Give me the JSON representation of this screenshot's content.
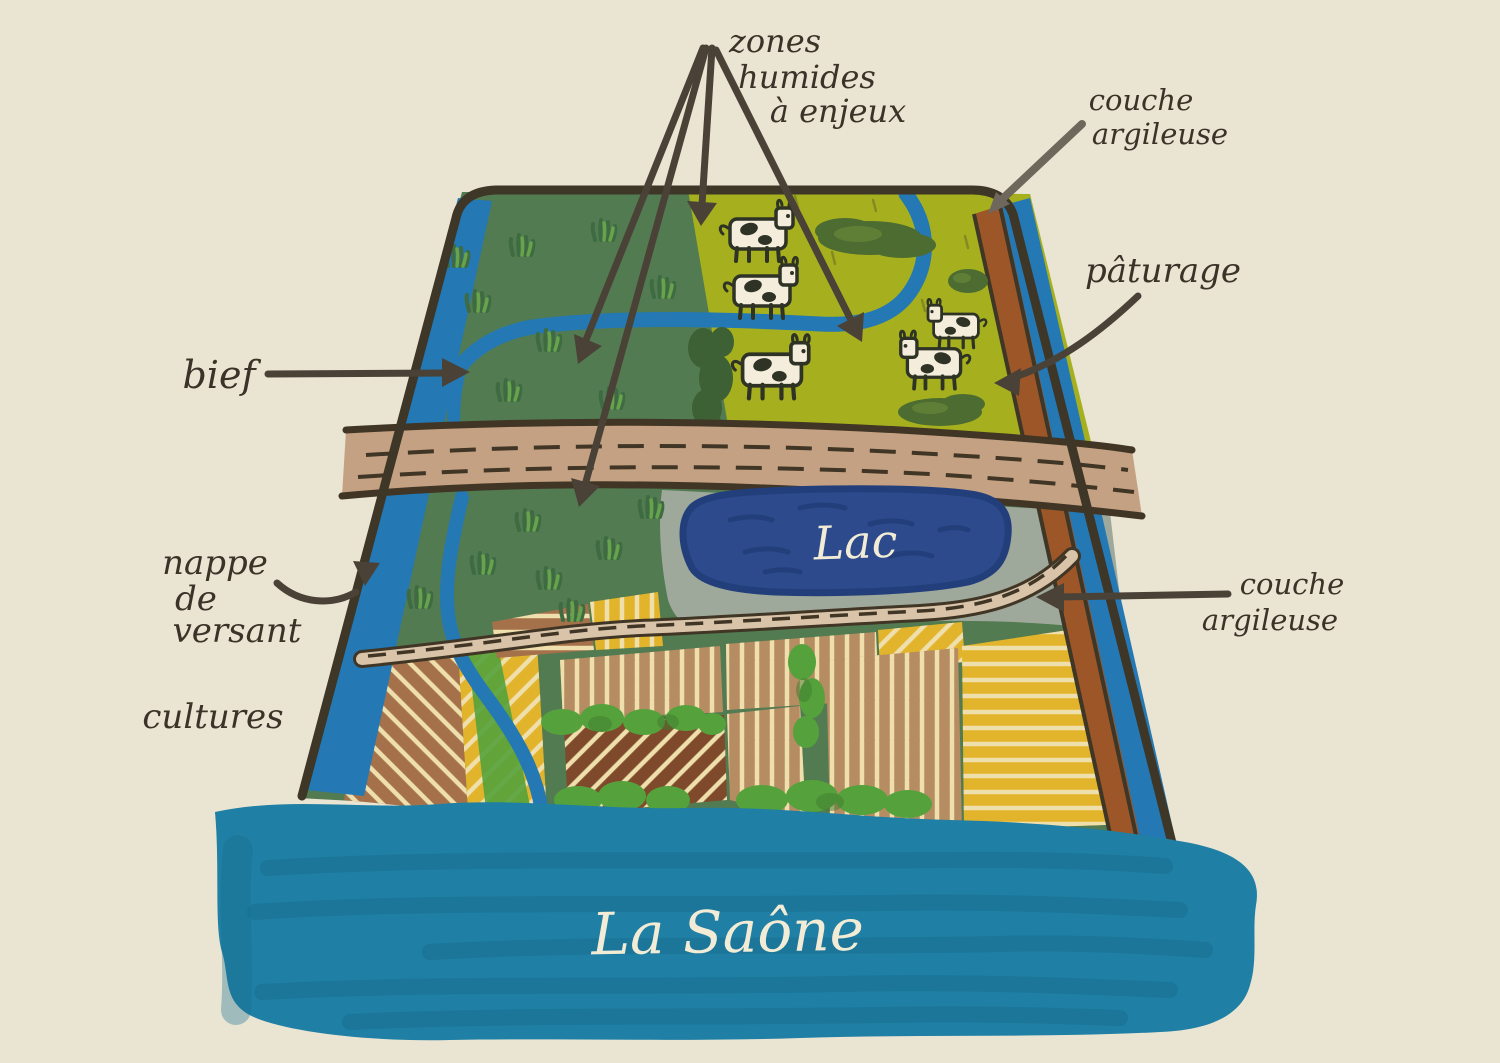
{
  "labels": {
    "zones_humides": {
      "lines": [
        "zones",
        "humides",
        "à enjeux"
      ]
    },
    "couche_argileuse_top": {
      "lines": [
        "couche",
        "argileuse"
      ]
    },
    "paturage": {
      "text": "pâturage"
    },
    "bief": {
      "text": "bief"
    },
    "nappe_de_versant": {
      "lines": [
        "nappe",
        "de",
        "versant"
      ]
    },
    "couche_argileuse_right": {
      "lines": [
        "couche",
        "argileuse"
      ]
    },
    "cultures": {
      "text": "cultures"
    },
    "lac": {
      "text": "Lac"
    },
    "la_saone": {
      "text": "La Saône"
    }
  },
  "scene": {
    "cow_count": 5,
    "features": [
      "bief",
      "nappe de versant",
      "cultures",
      "zones humides à enjeux",
      "couche argileuse",
      "pâturage",
      "lac",
      "La Saône"
    ]
  },
  "colors": {
    "bg": "#EAE4D3",
    "ink": "#3B3228",
    "text_light": "#F2ECD6",
    "arrow": "#4B4237",
    "arrow_light": "#6E675C",
    "outline": "#3E3626",
    "meadow": "#537B51",
    "meadow_dark": "#3E6B41",
    "tree": "#3D6134",
    "grass_light": "#67A24C",
    "pasture": "#A6B01E",
    "bush_dark": "#4D6C31",
    "bush_green": "#55A23C",
    "stream": "#2478B4",
    "clay": "#9C5627",
    "road": "#C5A183",
    "road_edge": "#413625",
    "hatch": "#EFDFAC",
    "gray": "#9FA99B",
    "lake": "#2C4A8C",
    "lake_dark": "#233F7B",
    "trail": "#D9C4A9",
    "field_yellow": "#E2B42B",
    "field_brown": "#A4714B",
    "field_brown_dark": "#7E4A2B",
    "field_tan": "#B68C63",
    "river": "#1F7FA4",
    "river_dark": "#17708F",
    "cow": "#F4EDDB",
    "cow_ink": "#2E3325"
  }
}
